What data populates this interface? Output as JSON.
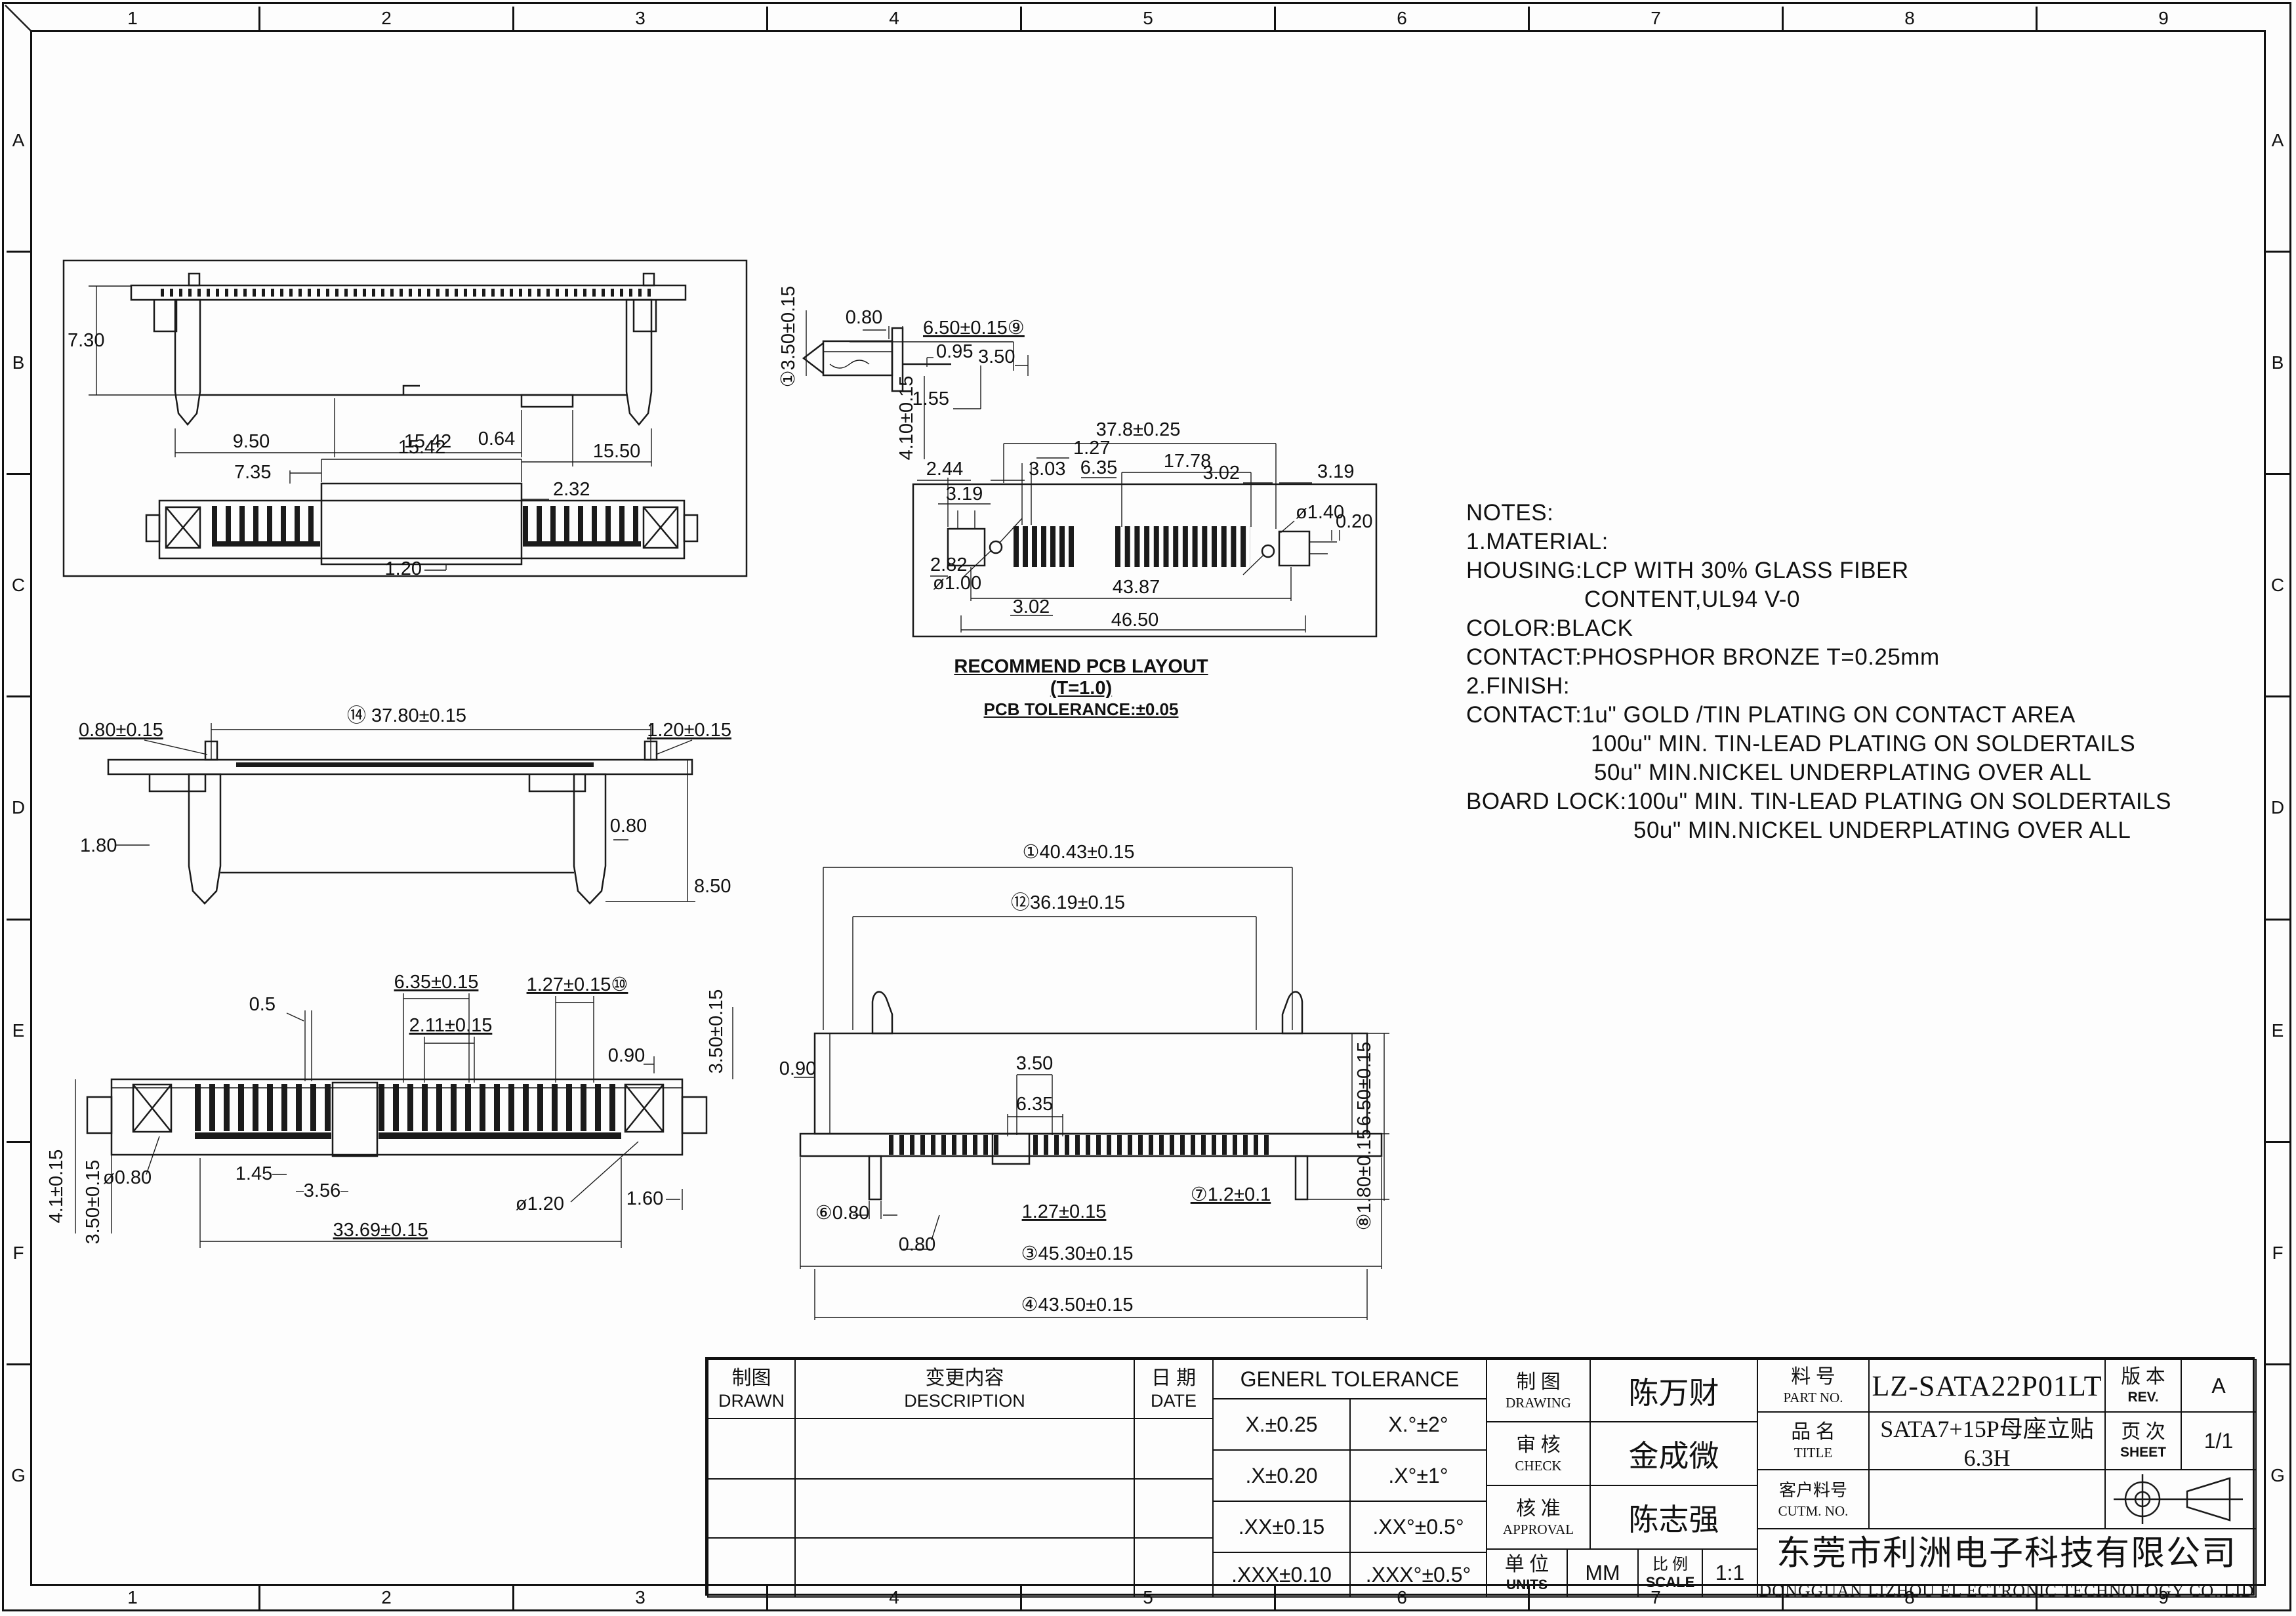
{
  "frame": {
    "columns": [
      "1",
      "2",
      "3",
      "4",
      "5",
      "6",
      "7",
      "8",
      "9"
    ],
    "rows": [
      "A",
      "B",
      "C",
      "D",
      "E",
      "F",
      "G"
    ]
  },
  "views": {
    "overview": {
      "side": {
        "h": "7.30",
        "a": "9.50",
        "b": "15.42",
        "c": "0.64",
        "d": "15.50"
      },
      "front": {
        "w": "15.42",
        "a": "7.35",
        "b": "2.32",
        "c": "1.20"
      }
    },
    "rear": {
      "a": "0.80±0.15",
      "b": "⑭ 37.80±0.15",
      "c": "1.20±0.15",
      "d": "1.80",
      "e": "0.80",
      "f": "8.50"
    },
    "plan": {
      "a": "0.5",
      "b": "6.35±0.15",
      "c": "1.27±0.15⑩",
      "d": "2.11±0.15",
      "e": "0.90",
      "f": "3.50±0.15",
      "g": "ø0.80",
      "h": "1.45",
      "i": "3.56",
      "j": "ø1.20",
      "k": "1.60",
      "l": "33.69±0.15",
      "m": "4.1±0.15",
      "n": "3.50±0.15"
    },
    "side_detail": {
      "a": "①3.50±0.15",
      "b": "0.80",
      "c": "6.50±0.15⑨",
      "d": "0.95",
      "e": "3.50",
      "f": "4.10±0.15",
      "g": "1.55"
    },
    "pcb": {
      "a": "37.8±0.25",
      "b": "1.27",
      "c": "3.03",
      "d": "6.35",
      "e": "17.78",
      "f": "3.02",
      "g": "3.19",
      "h": "2.44",
      "i": "3.19",
      "j": "2.82",
      "k": "ø1.00",
      "l": "43.87",
      "m": "3.02",
      "n": "46.50",
      "o": "ø1.40",
      "p": "0.20",
      "caption1": "RECOMMEND PCB LAYOUT (T=1.0)",
      "caption2": "PCB TOLERANCE:±0.05"
    },
    "bottom": {
      "a": "①40.43±0.15",
      "b": "⑫36.19±0.15",
      "c": "6.50±0.15",
      "d": "0.90",
      "e": "3.50",
      "f": "6.35",
      "g": "⑥0.80",
      "h": "0.80",
      "i": "1.27±0.15",
      "j": "⑦1.2±0.1",
      "k": "③45.30±0.15",
      "l": "④43.50±0.15",
      "m": "⑧1.80±0.15"
    }
  },
  "notes": {
    "lines": [
      "NOTES:",
      "1.MATERIAL:",
      "HOUSING:LCP WITH 30% GLASS FIBER",
      "CONTENT,UL94 V-0",
      "COLOR:BLACK",
      "CONTACT:PHOSPHOR BRONZE T=0.25mm",
      "2.FINISH:",
      "CONTACT:1u\" GOLD /TIN PLATING ON CONTACT AREA",
      "100u\" MIN. TIN-LEAD PLATING ON SOLDERTAILS",
      "50u\" MIN.NICKEL UNDERPLATING OVER ALL",
      "BOARD LOCK:100u\" MIN. TIN-LEAD PLATING ON SOLDERTAILS",
      "50u\" MIN.NICKEL UNDERPLATING OVER ALL"
    ]
  },
  "title_block": {
    "drawn_label_cn": "制图",
    "drawn_label_en": "DRAWN",
    "description_label_cn": "变更内容",
    "description_label_en": "DESCRIPTION",
    "date_label_cn": "日 期",
    "date_label_en": "DATE",
    "tolerance_title": "GENERL TOLERANCE",
    "tolerance_rows": [
      [
        "X.±0.25",
        "X.°±2°"
      ],
      [
        ".X±0.20",
        ".X°±1°"
      ],
      [
        ".XX±0.15",
        ".XX°±0.5°"
      ],
      [
        ".XXX±0.10",
        ".XXX°±0.5°"
      ]
    ],
    "drawing_label_cn": "制 图",
    "drawing_label_en": "DRAWING",
    "drawing_value": "陈万财",
    "check_label_cn": "审 核",
    "check_label_en": "CHECK",
    "check_value": "金成微",
    "approval_label_cn": "核 准",
    "approval_label_en": "APPROVAL",
    "approval_value": "陈志强",
    "units_label_cn": "单 位",
    "units_label_en": "UNITS",
    "units_value": "MM",
    "scale_label_cn": "比 例",
    "scale_label_en": "SCALE",
    "scale_value": "1:1",
    "part_no_label_cn": "料 号",
    "part_no_label_en": "PART NO.",
    "part_no_value": "LZ-SATA22P01LT",
    "title_label_cn": "品 名",
    "title_label_en": "TITLE",
    "title_value": "SATA7+15P母座立贴6.3H",
    "cutm_no_label_cn": "客户料号",
    "cutm_no_label_en": "CUTM. NO.",
    "cutm_no_value": "",
    "rev_label_cn": "版 本",
    "rev_label_en": "REV.",
    "rev_value": "A",
    "sheet_label_cn": "页 次",
    "sheet_label_en": "SHEET",
    "sheet_value": "1/1",
    "company_cn": "东莞市利洲电子科技有限公司",
    "company_en": "DONGGUAN LIZHOU EL ECTRONIC TECHNOLOGY CO.,LID"
  }
}
